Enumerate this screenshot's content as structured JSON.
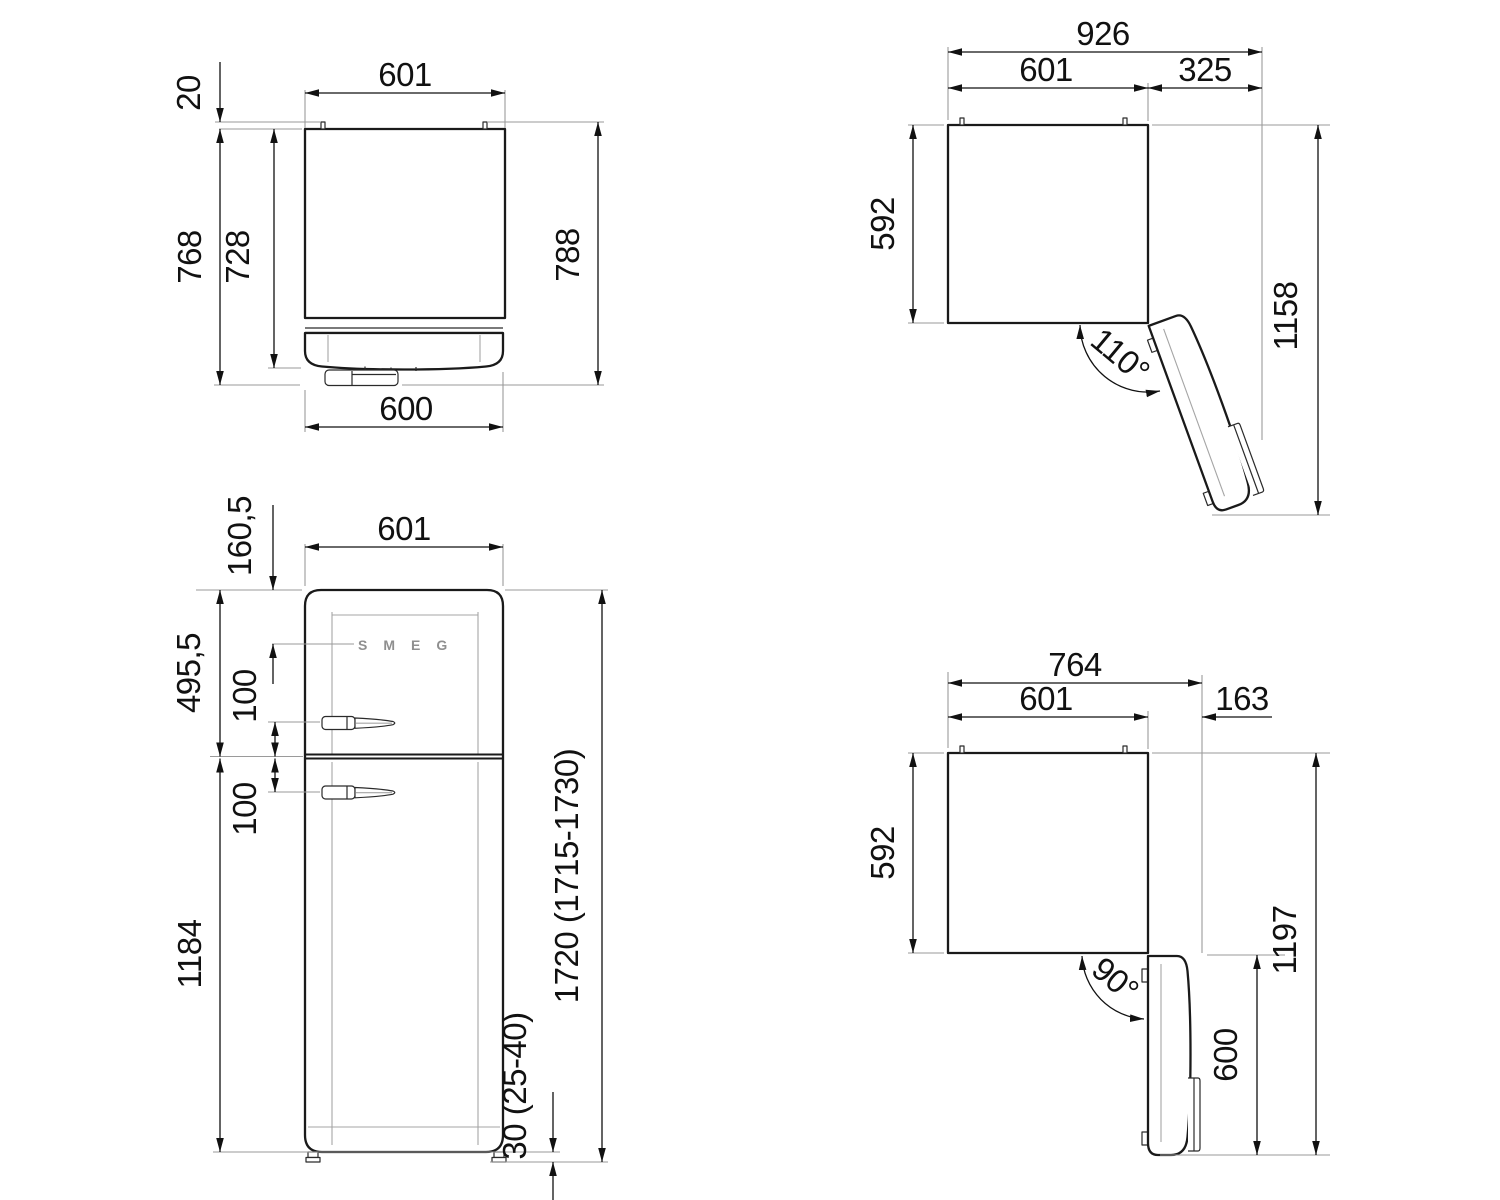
{
  "drawing": {
    "product": "refrigerator dimension drawing",
    "background": "#ffffff",
    "line_color": "#1a1a1a",
    "extension_line_color": "#9a9a9a",
    "views": {
      "top_closed": {
        "title": "top view, door closed",
        "dims": {
          "hinge_offset": "20",
          "width_top": "601",
          "depth_body": "728",
          "depth_with_door": "768",
          "depth_total": "788",
          "door_width": "600"
        }
      },
      "top_110": {
        "title": "top view, door open 110 degrees",
        "dims": {
          "total_width": "926",
          "cabinet_width": "601",
          "door_clearance": "325",
          "depth": "592",
          "total_depth": "1158",
          "angle": "110°"
        }
      },
      "front": {
        "title": "front view",
        "brand": "SMEG",
        "dims": {
          "top_to_logo": "160,5",
          "width": "601",
          "fridge_door_height": "495,5",
          "handle_above_split": "100",
          "handle_below_split": "100",
          "split_to_floor": "1184",
          "total_height": "1720 (1715-1730)",
          "feet_height": "30 (25-40)"
        }
      },
      "top_90": {
        "title": "top view, door open 90 degrees",
        "dims": {
          "total_width": "764",
          "cabinet_width": "601",
          "door_clearance": "163",
          "depth": "592",
          "total_depth": "1197",
          "angle": "90°",
          "door_length": "600"
        }
      }
    }
  }
}
